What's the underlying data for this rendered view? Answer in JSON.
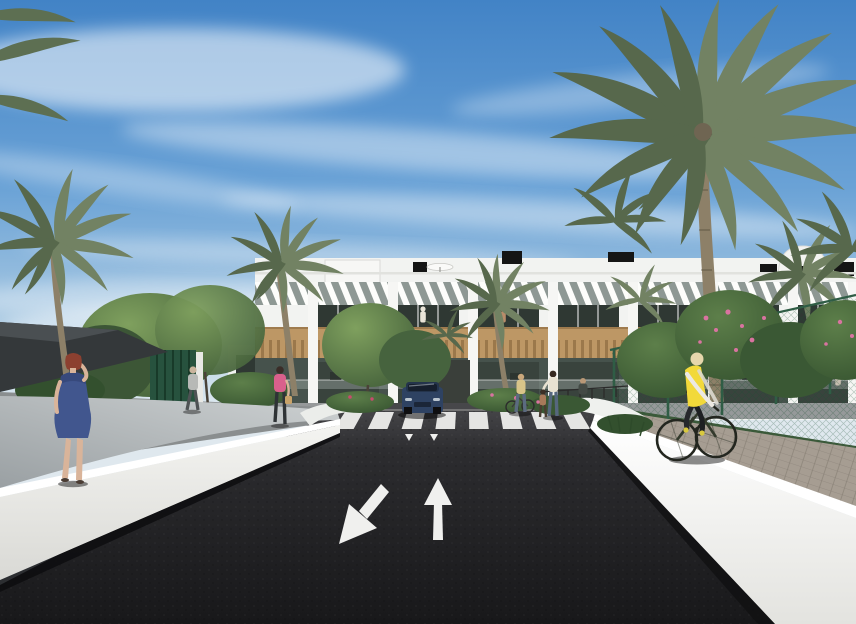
{
  "meta": {
    "type": "architectural-exterior-render",
    "description": "3D render of a white modern two-storey apartment complex with palm trees, an asphalt access road with a zebra crossing and two-way lane arrows, white boundary walls, a cyclist in a yellow vest on a side path, and several pedestrians"
  },
  "palette": {
    "sky-top": "#4283c6",
    "sky-mid": "#6aa2d6",
    "sky-low": "#a9c9e2",
    "sky-horizon": "#e2ebf0",
    "cloud": "#ffffff",
    "building-white": "#f2f3f1",
    "building-shade": "#dddfdb",
    "wood": "#bd9765",
    "wood-dark": "#8f6f42",
    "window-dark": "#2f3833",
    "window-glass": "#46524c",
    "slat-gap": "#8e9894",
    "palm-green": "#728263",
    "palm-green-dark": "#57684c",
    "palm-trunk": "#8d8068",
    "tree-green": "#4f6b44",
    "fence-green": "#2f5d45",
    "road": "#232325",
    "road-far": "#47474a",
    "marking": "#f0f0ee",
    "wall-white": "#efefec",
    "wall-bright": "#ffffff",
    "ramp-gray": "#9aa0a3",
    "ramp-light": "#cdd1d2",
    "path-gray": "#a69d92",
    "sail-dark": "#34383a",
    "car-blue": "#2e4262",
    "vest-yellow": "#f2d93a",
    "dress-blue": "#41568e",
    "hair-red": "#8c4030",
    "skin": "#d9b49a",
    "pink-top": "#d9608c",
    "flower-pink": "#d973a0"
  },
  "scene": {
    "road_markings": {
      "crosswalk_stripes": 8,
      "lane_arrow_left": "toward-viewer (down-left)",
      "lane_arrow_right": "away-from-viewer (up)",
      "give_way_marks": 2
    },
    "vehicles": [
      "dark-blue-suv-facing-viewer"
    ],
    "figures": [
      "woman-on-phone-blue-dress",
      "man-walking-grey",
      "woman-pink-with-handbag",
      "woman-with-bicycle",
      "woman-and-child",
      "seated-person",
      "cyclist-yellow-vest",
      "balcony-residents"
    ],
    "vegetation": [
      "date-palms",
      "leafy-trees",
      "flowering-shrubs",
      "hedge"
    ],
    "building": {
      "floors": 2,
      "style": "white-modern-apartment-block",
      "features": [
        "roof-slat-pergolas",
        "timber-cladding-band",
        "glass-balconies",
        "black-chimneys",
        "roof-dome"
      ]
    }
  }
}
